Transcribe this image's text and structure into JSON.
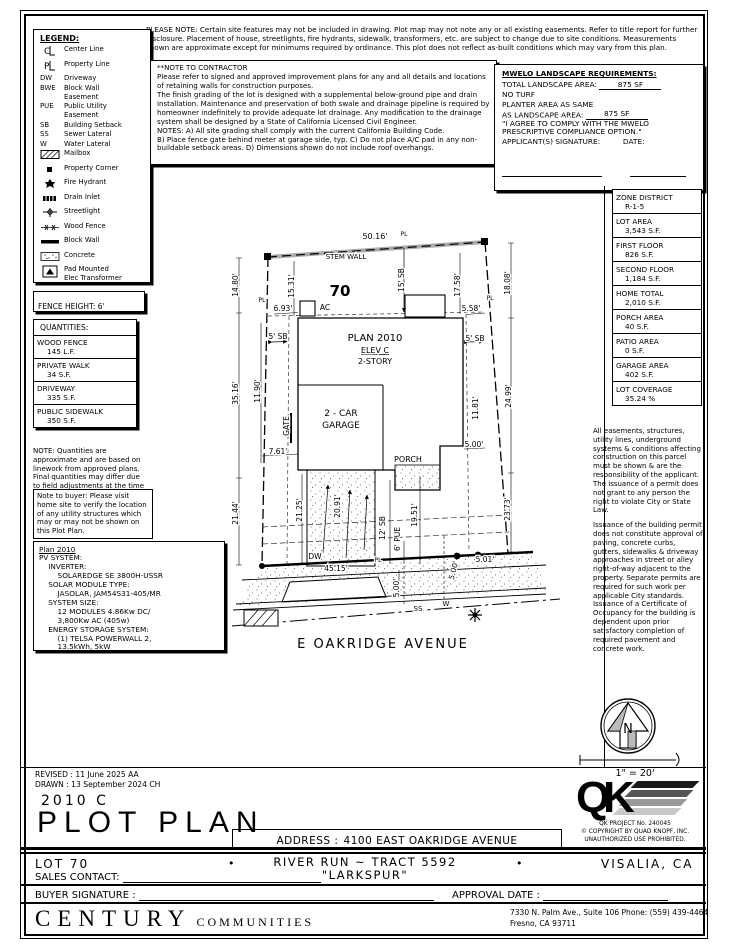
{
  "notes": {
    "please_note": "PLEASE NOTE:  Certain site features may not be included in drawing.  Plot map may not note any or all existing easements. Refer to title report for further disclosure.  Placement of house, streetlights, fire hydrants, sidewalk, transformers, etc. are subject to change due to site conditions.  Measurements shown are approximate except for minimums required by ordinance.  This plot does not reflect as-built conditions which may vary from this plan.",
    "contractor_title": "**NOTE TO CONTRACTOR",
    "contractor_body": "Please refer to signed and approved improvement plans for any and all details and locations of retaining walls for construction purposes.\nThe finish grading of the lot is designed with a supplemental below-ground pipe and drain installation.  Maintenance and preservation of both swale and drainage pipeline is required by homeowner indefinitely to provide adequate lot drainage.  Any modification to the drainage system shall be designed by a State of California Licensed Civil Engineer.\nNOTES:  A) All site grading shall comply with the current California Building Code.\nB) Place fence gate behind meter at garage side, typ.  C) Do not place A/C pad in any non-buildable setback areas.  D) Dimensions shown do not include roof overhangs.",
    "quantities_note": "NOTE: Quantities are  approximate and are based on linework from approved plans.  Final quantities may differ due to field adjustments at the time of construction.",
    "buyer_note": "Note to buyer: Please visit home site to verify the location of any utility structures which may or may not be shown on this Plot Plan."
  },
  "legend": {
    "title": "LEGEND:",
    "items": [
      {
        "icon": "centerline",
        "label": "Center Line"
      },
      {
        "icon": "propertyline",
        "label": "Property Line"
      },
      {
        "key": "DW",
        "label": "Driveway"
      },
      {
        "key": "BWE",
        "label": "Block Wall\nEasement"
      },
      {
        "key": "PUE",
        "label": "Public Utility\nEasement"
      },
      {
        "key": "SB",
        "label": "Building Setback"
      },
      {
        "key": "SS",
        "label": "Sewer Lateral"
      },
      {
        "key": "W",
        "label": "Water Lateral"
      },
      {
        "icon": "mailbox",
        "label": "Mailbox"
      },
      {
        "icon": "property-corner",
        "label": "Property Corner"
      },
      {
        "icon": "fire-hydrant",
        "label": "Fire Hydrant"
      },
      {
        "icon": "drain-inlet",
        "label": "Drain Inlet"
      },
      {
        "icon": "streetlight",
        "label": "Streetlight"
      },
      {
        "icon": "wood-fence",
        "label": "Wood Fence"
      },
      {
        "icon": "block-wall",
        "label": "Block Wall"
      },
      {
        "icon": "concrete",
        "label": "Concrete"
      },
      {
        "icon": "transformer",
        "label": "Pad Mounted\nElec Transformer\n(Above Ground)"
      },
      {
        "icon": "electric-splice",
        "label": "Electric Splice Box\n(Flush Mount)"
      },
      {
        "icon": "cable-splice",
        "label": "Cable Splice Box"
      }
    ]
  },
  "mwelo": {
    "title": "MWELO LANDSCAPE REQUIREMENTS:",
    "total_label": "TOTAL LANDSCAPE AREA:",
    "total_value": "875 SF",
    "no_turf": "NO TURF",
    "planter_line1": "PLANTER AREA AS SAME",
    "planter_label": "AS LANDSCAPE AREA:",
    "planter_value": "875 SF",
    "agree_line1": "\"I AGREE TO COMPLY WITH THE MWELO",
    "agree_line2": "PRESCRIPTIVE COMPLIANCE OPTION.\"",
    "signature_label": "APPLICANT(S) SIGNATURE:",
    "date_label": "DATE:"
  },
  "fence_height": "FENCE HEIGHT: 6'",
  "quantities": {
    "title": "QUANTITIES:",
    "rows": [
      {
        "name": "WOOD FENCE",
        "value": "145 L.F."
      },
      {
        "name": "PRIVATE WALK",
        "value": "34 S.F."
      },
      {
        "name": "DRIVEWAY",
        "value": "335 S.F."
      },
      {
        "name": "PUBLIC SIDEWALK",
        "value": "350 S.F."
      }
    ]
  },
  "pv": {
    "title": "Plan 2010",
    "body": "PV SYSTEM:\n    INVERTER:\n        SOLAREDGE SE 3800H-USSR\n    SOLAR MODULE TYPE:\n        JASOLAR, JAM54S31-405/MR\n    SYSTEM SIZE:\n        12 MODULES 4.86Kw DC/\n        3,800Kw AC (405w)\n    ENERGY STORAGE SYSTEM:\n        (1) TELSA POWERWALL 2,\n        13.5kWh, 5kW"
  },
  "zone_table": {
    "rows": [
      {
        "label": "ZONE DISTRICT",
        "value": "R-1-5"
      },
      {
        "label": "LOT AREA",
        "value": "3,543 S.F."
      },
      {
        "label": "FIRST FLOOR",
        "value": "826 S.F."
      },
      {
        "label": "SECOND FLOOR",
        "value": "1,184 S.F."
      },
      {
        "label": "HOME TOTAL",
        "value": "2,010 S.F."
      },
      {
        "label": "PORCH AREA",
        "value": "40 S.F."
      },
      {
        "label": "PATIO AREA",
        "value": "0 S.F."
      },
      {
        "label": "GARAGE AREA",
        "value": "402 S.F."
      },
      {
        "label": "LOT COVERAGE",
        "value": "35.24 %"
      }
    ]
  },
  "easements": {
    "p1": "All easements, structures, utility lines, underground systems & conditions affecting construction on this parcel must be shown & are the responsibility of the applicant. The issuance of a permit does not grant to any person the right to violate City or State Law.",
    "p2": "Issuance of the building permit does not constitute approval of paving, concrete curbs, gutters, sidewalks & driveway approaches in street or alley right-of-way adjacent to the property. Separate permits are required for such work per applicable City standards. Issuance of a Certificate of Occupancy for the building is dependent upon prior satisfactory completion of required pavement and concrete work."
  },
  "plot": {
    "lot_number": "70",
    "street_name": "E OAKRIDGE AVENUE",
    "compass_n": "N",
    "scale": "1\" = 20'",
    "labels": [
      {
        "t": "50.16'",
        "x": 147,
        "y": 11,
        "s": 8
      },
      {
        "t": "PL",
        "x": 176,
        "y": 8,
        "s": 6
      },
      {
        "t": "STEM WALL",
        "x": 118,
        "y": 31,
        "s": 7
      },
      {
        "t": "70",
        "x": 112,
        "y": 68,
        "s": 15,
        "b": 1
      },
      {
        "t": "14.80'",
        "x": 10,
        "y": 57,
        "s": 7.5,
        "r": -90
      },
      {
        "t": "15.31'",
        "x": 66,
        "y": 58,
        "s": 7.5,
        "r": -90
      },
      {
        "t": "15' SB",
        "x": 176,
        "y": 52,
        "s": 7.5,
        "r": -90
      },
      {
        "t": "17.58'",
        "x": 232,
        "y": 57,
        "s": 7.5,
        "r": -90
      },
      {
        "t": "18.08'",
        "x": 282,
        "y": 55,
        "s": 7.5,
        "r": -90
      },
      {
        "t": "6.93'",
        "x": 55,
        "y": 83,
        "s": 7.5
      },
      {
        "t": "AC",
        "x": 97,
        "y": 82,
        "s": 7.5
      },
      {
        "t": "5.58'",
        "x": 243,
        "y": 83,
        "s": 7.5
      },
      {
        "t": "5' SB",
        "x": 50,
        "y": 111,
        "s": 7.5
      },
      {
        "t": "5' SB",
        "x": 247,
        "y": 113,
        "s": 7.5
      },
      {
        "t": "PLAN 2010",
        "x": 147,
        "y": 113,
        "s": 10
      },
      {
        "t": "ELEV C",
        "x": 147,
        "y": 125,
        "s": 8,
        "u": 1
      },
      {
        "t": "2-STORY",
        "x": 147,
        "y": 136,
        "s": 8
      },
      {
        "t": "35.16'",
        "x": 10,
        "y": 165,
        "s": 7.5,
        "r": -90
      },
      {
        "t": "11.90'",
        "x": 32,
        "y": 163,
        "s": 7.5,
        "r": -90
      },
      {
        "t": "GATE",
        "x": 61,
        "y": 198,
        "s": 7.5,
        "r": -90
      },
      {
        "t": "7.61'",
        "x": 50,
        "y": 226,
        "s": 7.5
      },
      {
        "t": "2 - CAR",
        "x": 113,
        "y": 188,
        "s": 9
      },
      {
        "t": "GARAGE",
        "x": 113,
        "y": 200,
        "s": 9
      },
      {
        "t": "PORCH",
        "x": 180,
        "y": 234,
        "s": 8
      },
      {
        "t": "5.00'",
        "x": 246,
        "y": 219,
        "s": 7.5
      },
      {
        "t": "11.81'",
        "x": 250,
        "y": 180,
        "s": 7.5,
        "r": -90
      },
      {
        "t": "24.99'",
        "x": 283,
        "y": 168,
        "s": 7.5,
        "r": -90
      },
      {
        "t": "21.44'",
        "x": 10,
        "y": 285,
        "s": 7.5,
        "r": -90
      },
      {
        "t": "21.25'",
        "x": 74,
        "y": 282,
        "s": 7.5,
        "r": -90
      },
      {
        "t": "20.91'",
        "x": 112,
        "y": 278,
        "s": 7.5,
        "r": -90
      },
      {
        "t": "12' SB",
        "x": 157,
        "y": 300,
        "s": 7.5,
        "r": -90
      },
      {
        "t": "6' PUE",
        "x": 172,
        "y": 311,
        "s": 7.5,
        "r": -90
      },
      {
        "t": "19.51'",
        "x": 189,
        "y": 287,
        "s": 7.5,
        "r": -90
      },
      {
        "t": "23.73'",
        "x": 282,
        "y": 281,
        "s": 7.5,
        "r": -90
      },
      {
        "t": "DW",
        "x": 87,
        "y": 331,
        "s": 7.5
      },
      {
        "t": "45.15'",
        "x": 108,
        "y": 343,
        "s": 7.5
      },
      {
        "t": "PL",
        "x": 150,
        "y": 334,
        "s": 6
      },
      {
        "t": "PL",
        "x": 34,
        "y": 74,
        "s": 6
      },
      {
        "t": "PL",
        "x": 262,
        "y": 72,
        "s": 6
      },
      {
        "t": "5.00'",
        "x": 171,
        "y": 360,
        "s": 7.5,
        "r": -90
      },
      {
        "t": "5.00'",
        "x": 228,
        "y": 343,
        "s": 7.5,
        "r": -75
      },
      {
        "t": "5.01'",
        "x": 257,
        "y": 334,
        "s": 7.5
      },
      {
        "t": "SS",
        "x": 190,
        "y": 383,
        "s": 7
      },
      {
        "t": "W",
        "x": 218,
        "y": 378,
        "s": 7
      },
      {
        "t": "E OAKRIDGE AVENUE",
        "x": 155,
        "y": 420,
        "s": 13,
        "ls": 2
      }
    ]
  },
  "titleblock": {
    "revised": "REVISED :  11 June 2025   AA",
    "drawn": "DRAWN :  13 September 2024   CH",
    "plan_code": "2010 C",
    "title": "PLOT PLAN",
    "address_label": "ADDRESS :",
    "address_value": "4100 EAST OAKRIDGE AVENUE",
    "qk_q": "Q",
    "qk_k": "K",
    "qk_project": "QK PROJECT No. 240045",
    "qk_copyright": "© COPYRIGHT BY QUAD KNOPF, INC.",
    "qk_unauth": "UNAUTHORIZED USE PROHIBITED."
  },
  "footer": {
    "lot": "LOT 70",
    "bullet": "•",
    "tract": "RIVER RUN ~ TRACT 5592",
    "plan_name": "\"LARKSPUR\"",
    "city": "VISALIA, CA",
    "sales_label": "SALES CONTACT:",
    "buyer_label": "BUYER SIGNATURE :",
    "approval_label": "APPROVAL DATE :",
    "brand_main": "CENTURY",
    "brand_sub": "COMMUNITIES",
    "office_line1": "7330 N. Palm Ave., Suite 106    Phone:  (559) 439-4464",
    "office_line2": "Fresno, CA  93711"
  }
}
